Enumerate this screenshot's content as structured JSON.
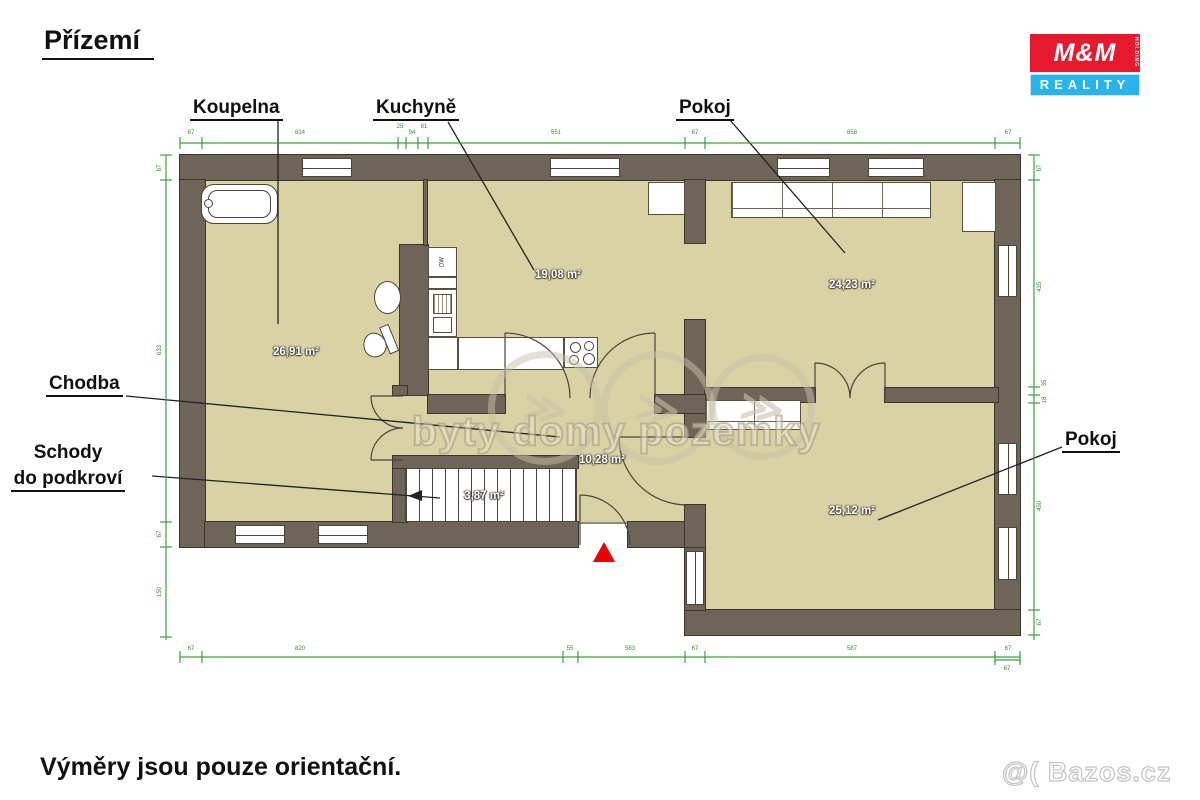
{
  "title": "Přízemí",
  "footer_note": "Výměry jsou pouze orientační.",
  "logo": {
    "top": "M&M",
    "holding": "HOLDING",
    "bottom": "REALITY"
  },
  "watermark": {
    "text": "byty domy pozemky",
    "corner": "@( Bazos.cz",
    "glyph": "≫"
  },
  "room_labels": {
    "koupelna": "Koupelna",
    "kuchyne": "Kuchyně",
    "pokoj_top": "Pokoj",
    "chodba": "Chodba",
    "schody_line1": "Schody",
    "schody_line2": "do podkroví",
    "pokoj_bottom": "Pokoj"
  },
  "areas": {
    "koupelna": "26,91 m²",
    "kuchyne": "19,08 m²",
    "pokoj_top": "24,23 m²",
    "chodba": "10,28 m²",
    "schody": "3,87 m²",
    "pokoj_bottom": "25,12 m²"
  },
  "fixtures": {
    "dishwasher": "DW"
  },
  "dimensions": {
    "top": [
      "67",
      "824",
      "25",
      "94",
      "81",
      "551",
      "67",
      "858",
      "67"
    ],
    "bottom": [
      "67",
      "820",
      "55",
      "583",
      "67",
      "587",
      "67"
    ],
    "left": [
      "67",
      "633",
      "67",
      "150"
    ],
    "right": [
      "67",
      "435",
      "35",
      "18",
      "450",
      "67"
    ],
    "corner": [
      "67"
    ]
  },
  "colors": {
    "wall": "#6f6458",
    "floor": "#d9d2a4",
    "dimension_green": "#3ba33b",
    "entrance_marker_red": "#e80000",
    "logo_red": "#e6192e",
    "logo_blue": "#2ab3e8"
  }
}
